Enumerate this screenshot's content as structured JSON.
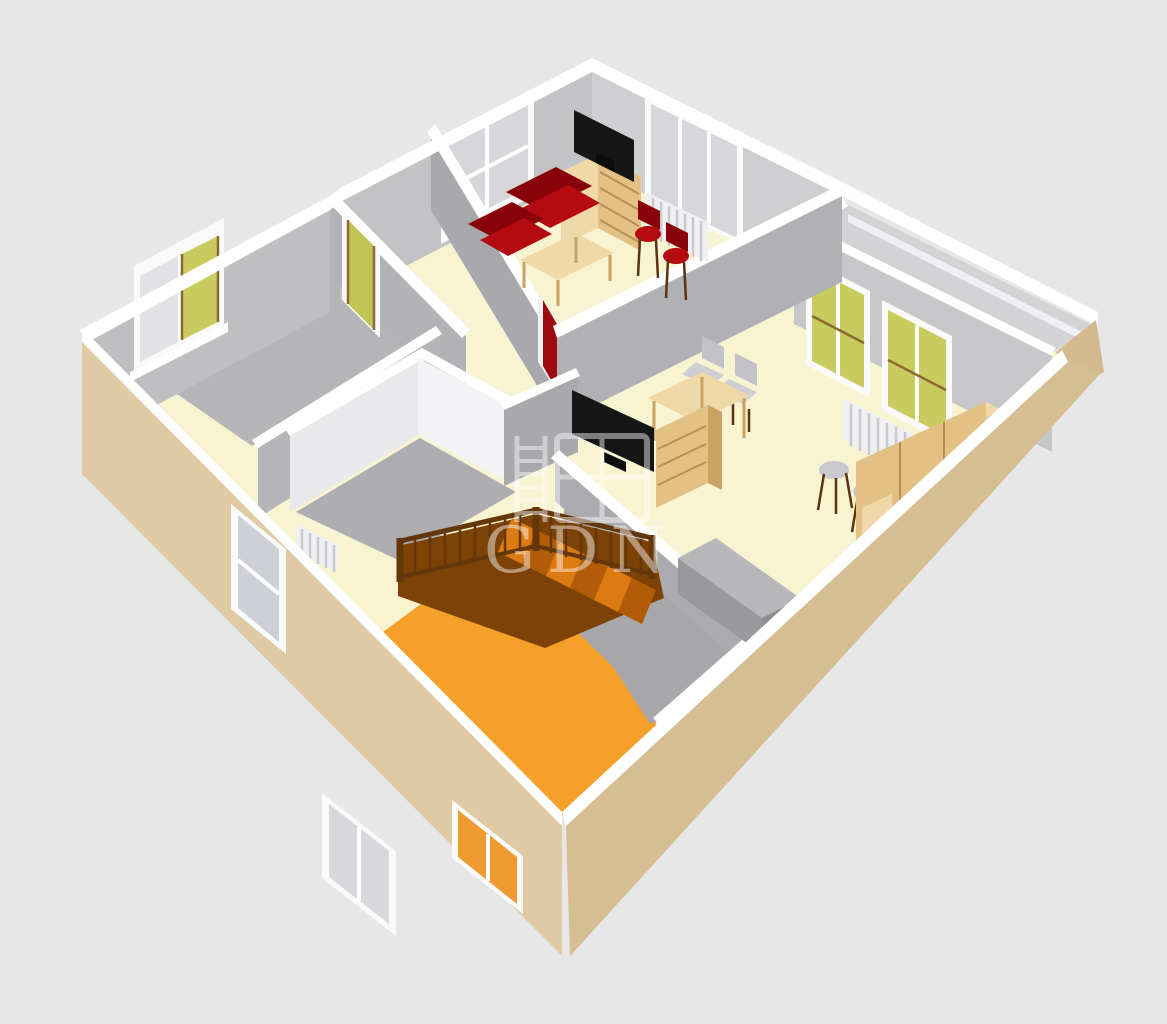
{
  "title": "3D floor plan cutaway render",
  "watermark": {
    "text": "GDN",
    "icon": "window-ladder-logo",
    "opacity": "0.45"
  },
  "scene": {
    "view": "isometric cutaway of one storey seen from the south-west corner above",
    "background_color": "#e7e7e8",
    "rooms": [
      {
        "name": "living-room",
        "floor": "cream"
      },
      {
        "name": "right-room",
        "floor": "cream"
      },
      {
        "name": "left-room",
        "floor": "gray"
      },
      {
        "name": "inner-room",
        "floor": "gray",
        "walls": "white"
      },
      {
        "name": "hallway",
        "floor": "cream"
      },
      {
        "name": "stair-room",
        "floor": "orange"
      },
      {
        "name": "landing",
        "floor": "gray"
      },
      {
        "name": "balcony",
        "floor": "light-gray"
      }
    ],
    "furniture": [
      "red-sofa",
      "red-armchair",
      "tv-on-wooden-dresser",
      "wooden-coffee-table",
      "red-bar-stools",
      "white-radiators",
      "wooden-dining-table",
      "dining-chairs",
      "second-tv-on-wooden-dresser",
      "gray-stool-chairs",
      "wooden-sideboard",
      "gray-bench",
      "wooden-staircase-with-brown-railing"
    ],
    "openings": [
      "double-window-gray-panes",
      "triple-window-gray-panes",
      "green-pane-windows",
      "left-room-window-green-sash",
      "green-door",
      "red-door",
      "entrance-door-glazed",
      "garden-door",
      "orange-lit-exterior-window"
    ]
  },
  "palette": {
    "bg": "#e7e7e8",
    "exterior-wall-left": "#e0caa4",
    "exterior-wall-right": "#d6be93",
    "interior-wall": "#b3b3b7",
    "wall-top-edge": "#ffffff",
    "floor-cream": "#f8f3d0",
    "floor-orange": "#f5a028",
    "floor-gray": "#b5b5b8",
    "balcony-floor": "#d3d3d6",
    "wood": "#e3c083",
    "sofa-red": "#b40a10",
    "door-red": "#9c0a10",
    "window-pane-green": "#c8cc5e",
    "stair-railing-brown": "#63370a",
    "stair-tread-orange": "#dd7a12",
    "tv-black": "#161616",
    "watermark-white": "#ffffff"
  }
}
